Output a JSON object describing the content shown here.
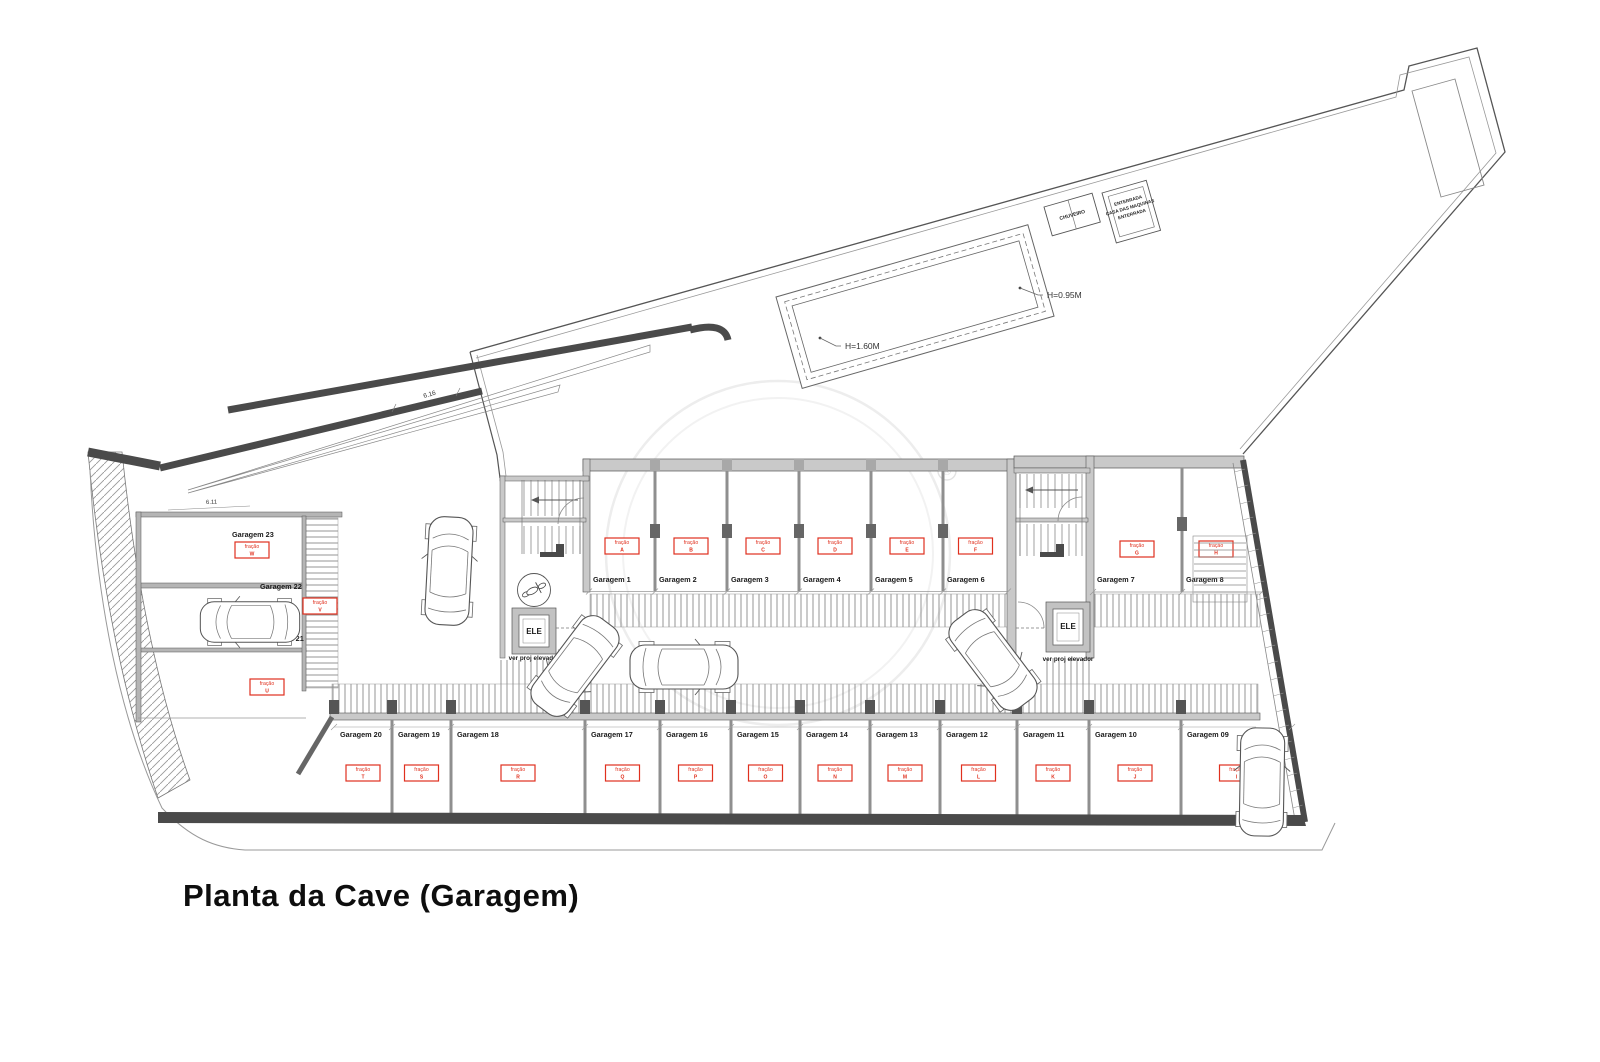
{
  "title": "Planta da Cave (Garagem)",
  "plan": {
    "fracao_word": "fração",
    "watermark_symbol": "®",
    "pool": {
      "deep": "H=1.60M",
      "shallow": "H=0.95M"
    },
    "machine_room_lines": [
      "ENTERRADA",
      "CASA DAS MAQUINAS",
      "ENTERRADA"
    ],
    "shower_label": "CHUVEIRO",
    "elevator": {
      "label": "ELE",
      "note": "ver proj elevador"
    },
    "dimensions": {
      "ramp": "6.16",
      "garage23": "6.11"
    },
    "garages": {
      "top_row": [
        {
          "name": "Garagem 1",
          "fracao": "A"
        },
        {
          "name": "Garagem 2",
          "fracao": "B"
        },
        {
          "name": "Garagem 3",
          "fracao": "C"
        },
        {
          "name": "Garagem 4",
          "fracao": "D"
        },
        {
          "name": "Garagem 5",
          "fracao": "E"
        },
        {
          "name": "Garagem 6",
          "fracao": "F"
        }
      ],
      "top_right": [
        {
          "name": "Garagem 7",
          "fracao": "G"
        },
        {
          "name": "Garagem 8",
          "fracao": "H"
        }
      ],
      "bottom_row": [
        {
          "name": "Garagem 20",
          "fracao": "T"
        },
        {
          "name": "Garagem 19",
          "fracao": "S"
        },
        {
          "name": "Garagem 18",
          "fracao": "R"
        },
        {
          "name": "Garagem 17",
          "fracao": "Q"
        },
        {
          "name": "Garagem 16",
          "fracao": "P"
        },
        {
          "name": "Garagem 15",
          "fracao": "O"
        },
        {
          "name": "Garagem 14",
          "fracao": "N"
        },
        {
          "name": "Garagem 13",
          "fracao": "M"
        },
        {
          "name": "Garagem 12",
          "fracao": "L"
        },
        {
          "name": "Garagem 11",
          "fracao": "K"
        },
        {
          "name": "Garagem 10",
          "fracao": "J"
        },
        {
          "name": "Garagem 09",
          "fracao": "I"
        }
      ],
      "left_side": [
        {
          "name": "Garagem 23",
          "fracao": "W"
        },
        {
          "name": "Garagem 22",
          "fracao": "V"
        },
        {
          "name": "Garagem 21",
          "fracao": "U"
        }
      ]
    }
  }
}
